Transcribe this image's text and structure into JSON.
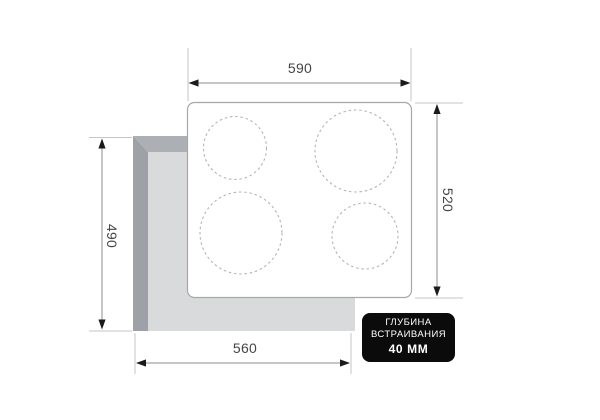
{
  "diagram": {
    "title_semantic": "cooktop-built-in-installation-dimensions",
    "dimensions": {
      "top_width": "590",
      "right_depth": "520",
      "left_cutout_depth": "490",
      "bottom_cutout_width": "560"
    },
    "badge": {
      "line1": "ГЛУБИНА",
      "line2": "ВСТРАИВАНИЯ",
      "line3": "40 ММ"
    },
    "burner_count": "4",
    "colors": {
      "cutout_band_left": "#9ea2a8",
      "cutout_band_top": "#acb0b5",
      "cutout_fill": "#d9dadb",
      "cooktop_fill": "#ffffff",
      "cooktop_stroke": "#a8a8a8",
      "burner_dash": "#b4b4b4",
      "dimension_line": "#8c8c8c",
      "extension_line": "#c6c6c6",
      "arrow": "#1b1b1b",
      "label_text": "#454545",
      "badge_bg": "#0b0b0b",
      "badge_text": "#ffffff"
    }
  }
}
